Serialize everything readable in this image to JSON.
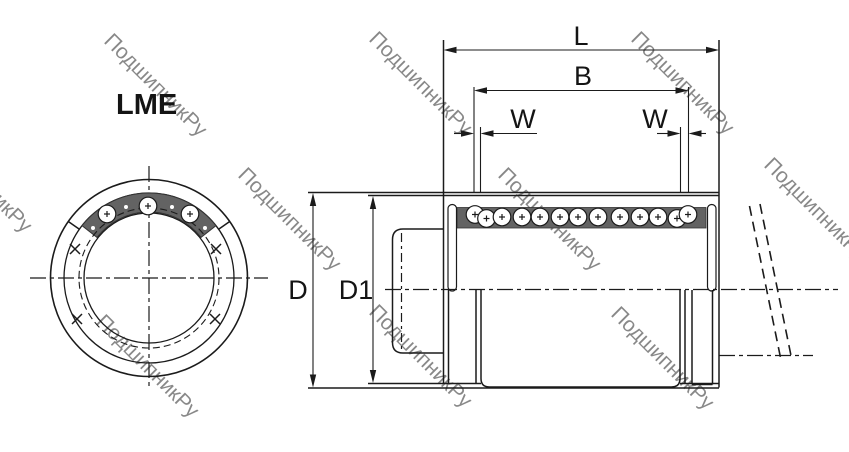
{
  "labels": {
    "series": "LME"
  },
  "dimensions": {
    "total_length": "L",
    "between_grooves": "B",
    "groove_width": "W",
    "outer_diameter": "D",
    "intermediate_diameter": "D1"
  },
  "watermark": {
    "text": "ПодшипникРу",
    "color": "#b8b8b8"
  },
  "colors": {
    "background": "#ffffff",
    "line": "#1b1b1b",
    "ball_track": "#636363",
    "ball_fill": "#ffffff"
  }
}
